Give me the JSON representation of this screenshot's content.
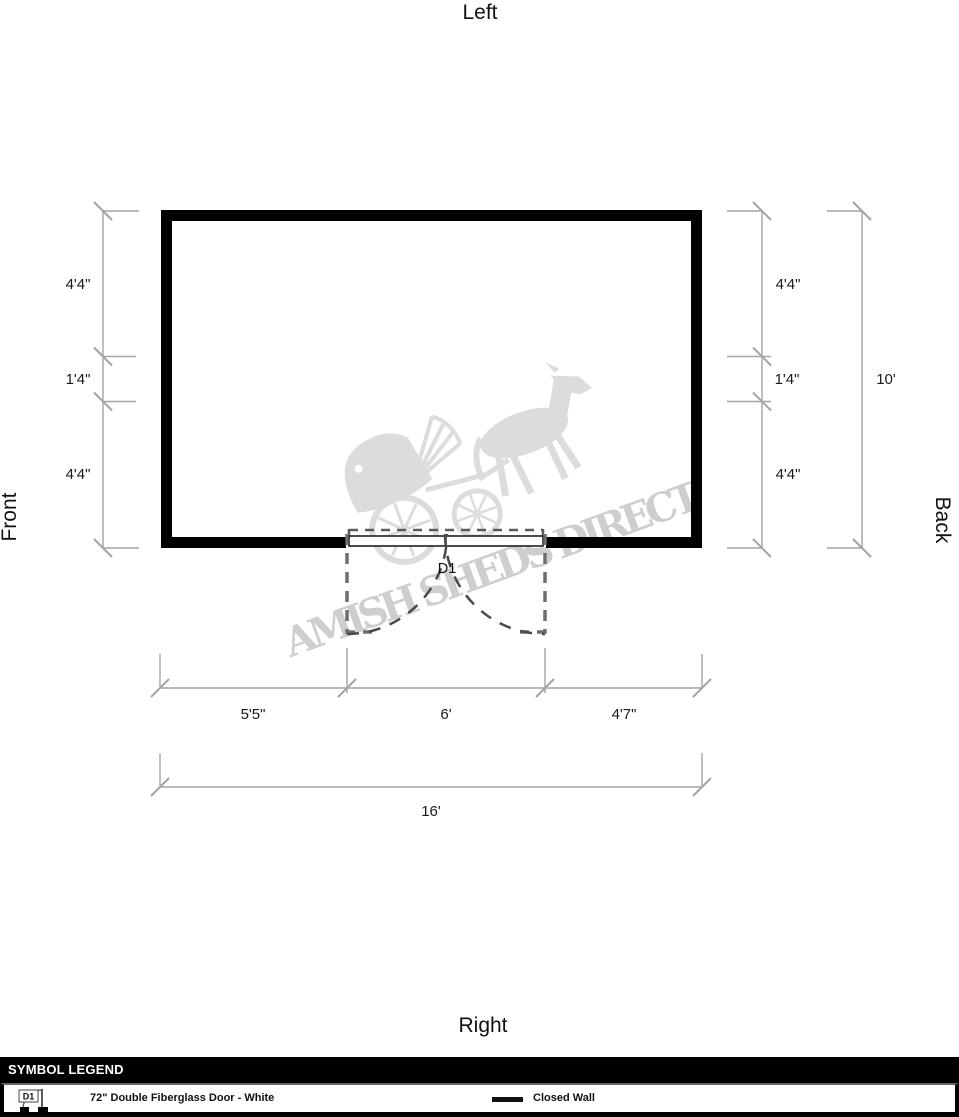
{
  "orientation": {
    "top": "Left",
    "bottom": "Right",
    "left": "Front",
    "right": "Back"
  },
  "dimensions": {
    "left_chain": [
      "4'4\"",
      "1'4\"",
      "4'4\""
    ],
    "right_chain": [
      "4'4\"",
      "1'4\"",
      "4'4\""
    ],
    "right_total": "10'",
    "bottom_chain": [
      "5'5\"",
      "6'",
      "4'7\""
    ],
    "bottom_total": "16'"
  },
  "door": {
    "label": "D1"
  },
  "watermark": {
    "text": "AMISH SHEDS DIRECT"
  },
  "legend": {
    "title": "SYMBOL LEGEND",
    "items": [
      {
        "symbol": "d1-door-symbol",
        "label": "72\" Double Fiberglass Door - White"
      },
      {
        "symbol": "closed-wall-line",
        "label": "Closed Wall"
      }
    ]
  },
  "colors": {
    "wall": "#000000",
    "dimension_line": "#a4a4a4",
    "dimension_text": "#1a1a1a",
    "door_dash": "#6e6e6e",
    "swing_arc": "#4a4a4a",
    "watermark": "#cccccc",
    "legend_bar": "#000000"
  }
}
